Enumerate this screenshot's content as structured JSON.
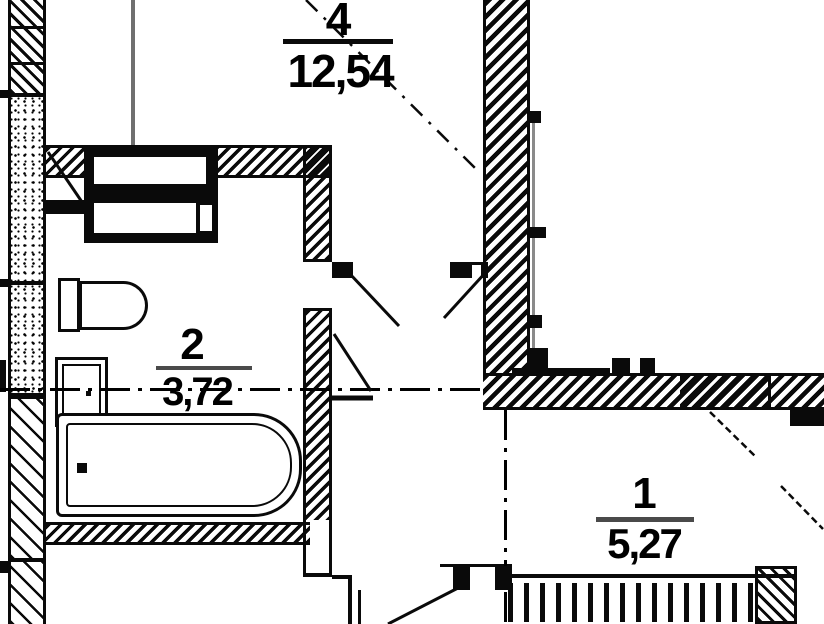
{
  "drawing": {
    "kind": "apartment floor plan fragment",
    "background_color": "#ffffff",
    "line_color": "#000000",
    "secondary_line_color": "#888888",
    "rooms": [
      {
        "number": "4",
        "area": "12,54"
      },
      {
        "number": "2",
        "area": "3,72"
      },
      {
        "number": "1",
        "area": "5,27"
      }
    ],
    "fixtures": [
      "ventilation-shaft",
      "toilet",
      "sink",
      "bathtub",
      "radiator-sill"
    ]
  }
}
